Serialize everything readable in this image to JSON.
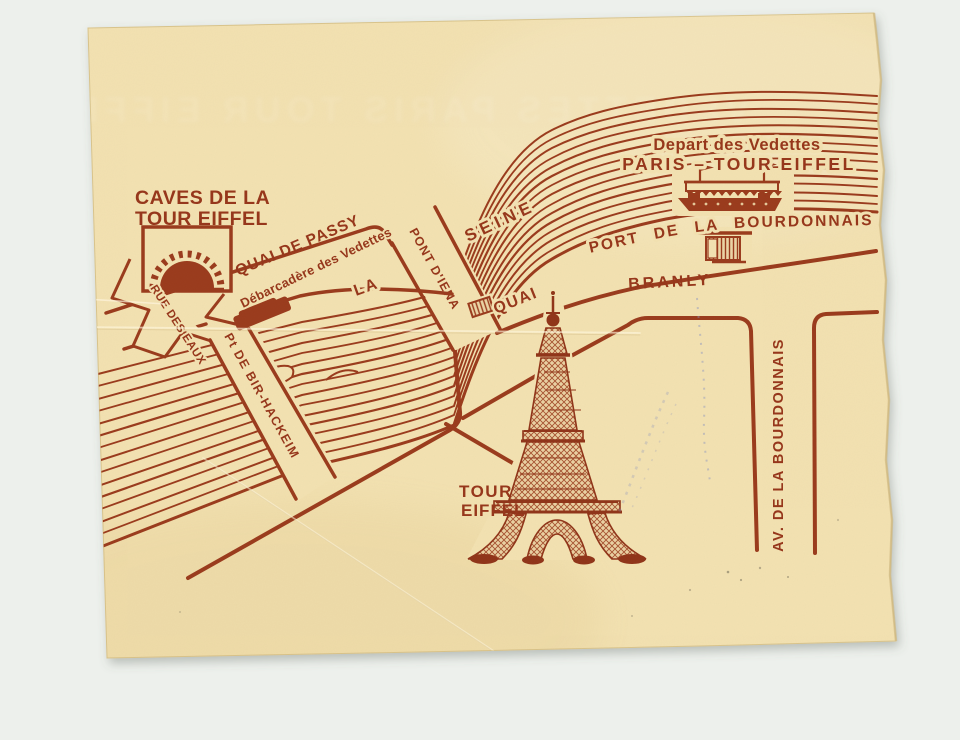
{
  "title": "Vedettes Paris Tour Eiffel ticket - map on back",
  "colors": {
    "ink": "#9a3a1c",
    "paper": "#f3e2b2",
    "background": "#edf0ec",
    "stamp_blue": "#8a93c0"
  },
  "ghost_text": "VEDETTES PARIS TOUR EIFFEL",
  "map": {
    "labels": {
      "caves_line1": "CAVES DE LA",
      "caves_line2": "TOUR EIFFEL",
      "rue_des_eaux": "RUE DES EAUX",
      "quai_de_passy": "QUAI DE PASSY",
      "debarcadere": "Débarcadère des Vedettes",
      "pont_bir_hakeim": "Pt DE BIR-HACKEIM",
      "pont_iena": "PONT D'IENA",
      "river_la": "LA",
      "river_seine": "SEINE",
      "depart_line1": "Depart des Vedettes",
      "depart_line2": "PARIS – TOUR EIFFEL",
      "port_bourdonnais": "PORT DE LA BOURDONNAIS",
      "quai": "QUAI",
      "branly": "BRANLY",
      "tour": "TOUR",
      "eiffel": "EIFFEL",
      "av_bourdonnais": "AV. DE LA BOURDONNAIS"
    },
    "icons": [
      "caves-tunnel-icon",
      "pier-marker-icon",
      "tour-boat-icon",
      "ticket-booth-icon",
      "monument-marker-icon",
      "eiffel-tower-icon"
    ]
  }
}
